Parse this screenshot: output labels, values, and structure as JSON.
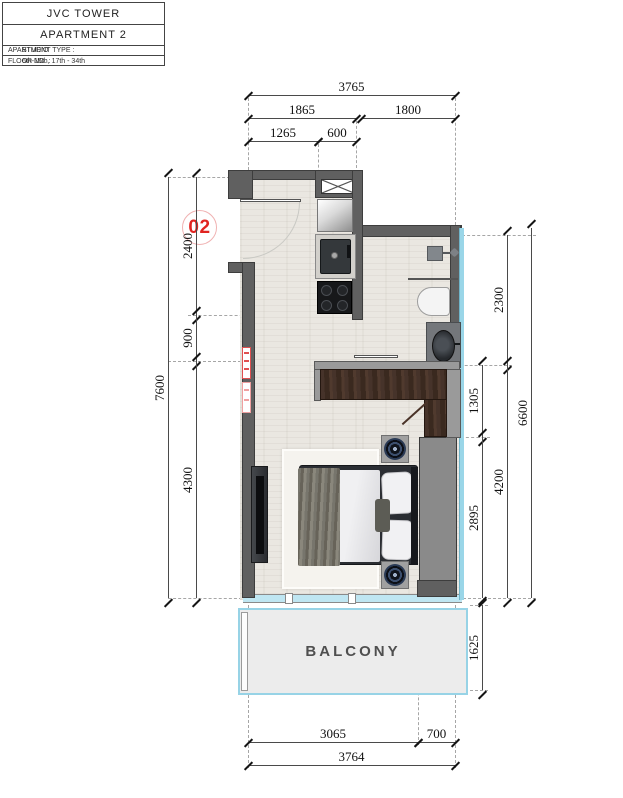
{
  "title_block": {
    "line1": "JVC TOWER",
    "line2": "APARTMENT  2",
    "type_label": "APARTMENT TYPE :",
    "type_value": "STUDIO",
    "floor_label": "FLOOR NO. :",
    "floor_value": "6th-15th, 17th - 34th"
  },
  "unit_badge": "02",
  "labels": {
    "balcony": "BALCONY"
  },
  "dimensions": {
    "top": {
      "total": "3765",
      "left": "1865",
      "right": "1800",
      "inner_left": "1265",
      "inner_right": "600"
    },
    "left": {
      "total": "7600",
      "top": "2400",
      "mid": "900",
      "bottom": "4300"
    },
    "right": {
      "total": "6600",
      "top": "2300",
      "upper_mid": "1305",
      "lower": "4200",
      "bed_zone": "2895",
      "balcony": "1625"
    },
    "bottom": {
      "main": "3065",
      "side": "700",
      "total": "3764"
    }
  },
  "colors": {
    "wall": "#606060",
    "accent_red": "#e02420",
    "glass": "#97d3e6",
    "wood_dark": "#3a291f",
    "floor": "#eae7e1"
  }
}
